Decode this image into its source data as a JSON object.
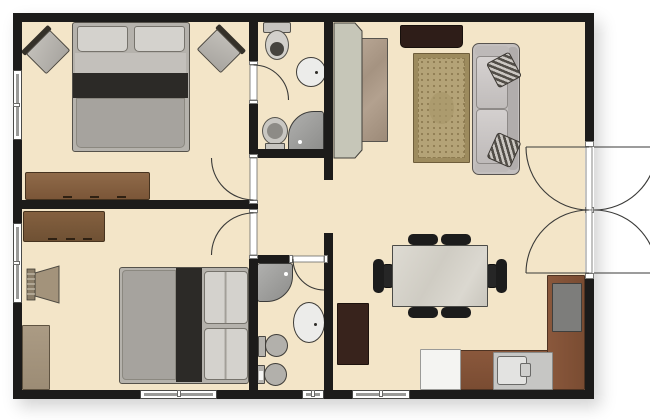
{
  "diagram_type": "apartment-floor-plan",
  "canvas": {
    "w": 650,
    "h": 420
  },
  "palette": {
    "floor": "#f3e5c8",
    "wall": "#1c1b1a",
    "outside": "#ffffff",
    "fixture_light": "#ececea",
    "fixture_gray": "#b2b0ab",
    "shower_gray": "#9b9b99",
    "counter_brown": "#7c4e35",
    "dark_wood": "#2e1d18",
    "mid_wood": "#8a6144",
    "bed_gray": "#a6a39e",
    "bed_dark_band": "#2c2a27",
    "pillow": "#d4d2cd",
    "sofa_gray": "#c3bfbe",
    "rug_tan": "#b4a377",
    "table_stone": "#d9d6ce",
    "chair_black": "#1c1c1c",
    "arc_line": "#3a3a38"
  },
  "rooms": [
    {
      "name": "bedroom-1",
      "bounds": [
        22,
        22,
        227,
        178
      ]
    },
    {
      "name": "ensuite-bathroom",
      "bounds": [
        258,
        22,
        66,
        127
      ]
    },
    {
      "name": "hallway",
      "bounds": [
        258,
        158,
        66,
        97
      ]
    },
    {
      "name": "bedroom-2",
      "bounds": [
        22,
        209,
        227,
        181
      ]
    },
    {
      "name": "bathroom-2",
      "bounds": [
        258,
        263,
        66,
        127
      ]
    },
    {
      "name": "living-dining-kitchen",
      "bounds": [
        333,
        22,
        252,
        368
      ]
    }
  ],
  "walls": [
    {
      "name": "wall-top",
      "r": [
        13,
        13,
        581,
        9
      ]
    },
    {
      "name": "wall-bottom",
      "r": [
        13,
        390,
        581,
        9
      ]
    },
    {
      "name": "wall-left",
      "r": [
        13,
        13,
        9,
        386
      ]
    },
    {
      "name": "wall-right-upper",
      "r": [
        585,
        13,
        9,
        134
      ]
    },
    {
      "name": "wall-right-lower",
      "r": [
        585,
        273,
        9,
        126
      ]
    },
    {
      "name": "wall-bedroom-divider",
      "r": [
        13,
        200,
        245,
        9
      ]
    },
    {
      "name": "wall-v1-a",
      "r": [
        249,
        22,
        9,
        43
      ]
    },
    {
      "name": "wall-v1-b",
      "r": [
        249,
        100,
        9,
        58
      ]
    },
    {
      "name": "wall-v1-c",
      "r": [
        249,
        200,
        9,
        13
      ]
    },
    {
      "name": "wall-v1-d",
      "r": [
        249,
        255,
        9,
        144
      ]
    },
    {
      "name": "wall-v2-a",
      "r": [
        324,
        22,
        9,
        158
      ]
    },
    {
      "name": "wall-v2-b",
      "r": [
        324,
        233,
        9,
        166
      ]
    },
    {
      "name": "wall-bath1-bottom",
      "r": [
        249,
        149,
        84,
        9
      ]
    },
    {
      "name": "wall-bath2-top",
      "r": [
        258,
        255,
        35,
        8
      ]
    }
  ],
  "windows": [
    {
      "name": "window-bedroom1-left",
      "r": [
        13,
        70,
        9,
        70
      ],
      "dir": "v"
    },
    {
      "name": "window-bedroom2-left",
      "r": [
        13,
        223,
        9,
        80
      ],
      "dir": "v"
    },
    {
      "name": "window-bedroom2-bottom",
      "r": [
        140,
        390,
        77,
        9
      ],
      "dir": "h"
    },
    {
      "name": "window-bathroom2-bottom",
      "r": [
        302,
        390,
        22,
        9
      ],
      "dir": "h"
    },
    {
      "name": "window-dining-bottom",
      "r": [
        352,
        390,
        58,
        9
      ],
      "dir": "h"
    }
  ],
  "doors": [
    {
      "name": "door-ensuite",
      "gap": [
        249,
        65,
        9,
        35
      ],
      "leaf": [
        250,
        65,
        7,
        35
      ],
      "jambs": [
        [
          249,
          61,
          9,
          4
        ],
        [
          249,
          100,
          9,
          4
        ]
      ],
      "arcs": [
        "M253.5,65 A35,35 0 0 1 288.5,100"
      ],
      "lines": []
    },
    {
      "name": "door-bedroom1",
      "gap": [
        249,
        158,
        9,
        42
      ],
      "leaf": [
        250,
        158,
        7,
        42
      ],
      "jambs": [
        [
          249,
          154,
          9,
          4
        ],
        [
          249,
          200,
          9,
          4
        ]
      ],
      "arcs": [
        "M211.5,158 A42,42 0 0 0 253.5,200"
      ],
      "lines": []
    },
    {
      "name": "door-bedroom2",
      "gap": [
        249,
        213,
        9,
        42
      ],
      "leaf": [
        250,
        213,
        7,
        42
      ],
      "jambs": [
        [
          249,
          209,
          9,
          4
        ],
        [
          249,
          255,
          9,
          4
        ]
      ],
      "arcs": [
        "M253.5,213 A42,42 0 0 0 211.5,255"
      ],
      "lines": []
    },
    {
      "name": "door-bathroom2",
      "gap": [
        293,
        255,
        31,
        8
      ],
      "leaf": [
        293,
        256,
        31,
        6
      ],
      "jambs": [
        [
          289,
          255,
          4,
          8
        ],
        [
          324,
          255,
          4,
          8
        ]
      ],
      "arcs": [
        "M293,259 A31,31 0 0 0 324,290"
      ],
      "lines": []
    },
    {
      "name": "entry-double-door",
      "gap": [
        585,
        147,
        9,
        126
      ],
      "leaf": [
        586,
        147,
        6,
        63
      ],
      "leaf2": [
        586,
        210,
        6,
        63
      ],
      "jambs": [
        [
          585,
          141,
          9,
          6
        ],
        [
          585,
          273,
          9,
          6
        ],
        [
          585,
          207,
          9,
          6
        ]
      ],
      "arcs": [
        "M526,147 A63,63 0 0 0 589,210",
        "M526,273 A63,63 0 0 1 589,210",
        "M657,147 A63,63 0 0 1 594,210",
        "M657,273 A63,63 0 0 0 594,210"
      ],
      "lines": [
        [
          526,
          147,
          589,
          147
        ],
        [
          526,
          273,
          589,
          273
        ],
        [
          594,
          147,
          657,
          147
        ],
        [
          594,
          273,
          657,
          273
        ]
      ]
    }
  ],
  "furniture": [
    {
      "name": "living-room-rug",
      "type": "rug",
      "r": [
        413,
        53,
        57,
        110
      ]
    },
    {
      "name": "wardrobe-back-panel",
      "type": "svg",
      "items": [
        {
          "k": "polygon",
          "pts": "334,23 355,23 362,31 362,150 355,158 334,158",
          "fill": "#c6c6b8",
          "stroke": "#42403a",
          "sw": 1
        }
      ]
    },
    {
      "name": "wardrobe-stone-front",
      "type": "rect",
      "r": [
        356,
        38,
        32,
        104
      ],
      "grad": "linear-gradient(135deg,#b9a795 0%,#a59381 35%,#b3a18f 60%,#9c8a78 100%)",
      "border": "1px solid #57544e"
    },
    {
      "name": "tv-credenza",
      "type": "rect",
      "r": [
        400,
        25,
        63,
        23
      ],
      "bg": "#2e1d18",
      "border": "1px solid #17100c",
      "radius": "2px 2px 5px 5px"
    },
    {
      "name": "sofa",
      "type": "sofa",
      "r": [
        472,
        43,
        48,
        132
      ]
    },
    {
      "name": "bed-bedroom1",
      "type": "bed",
      "r": [
        72,
        22,
        118,
        130
      ],
      "dir": "down"
    },
    {
      "name": "accent-chair-left",
      "type": "rchair",
      "r": [
        27,
        33,
        40,
        36
      ],
      "rot": -45
    },
    {
      "name": "accent-chair-right",
      "type": "rchair",
      "r": [
        200,
        32,
        40,
        36
      ],
      "rot": 45
    },
    {
      "name": "dresser-bedroom1",
      "type": "dresser",
      "r": [
        25,
        172,
        125,
        28
      ],
      "c1": "#8f6a49",
      "c2": "#7b5638"
    },
    {
      "name": "toilet-ensuite",
      "type": "toilet-v",
      "r": [
        263,
        22,
        28,
        38
      ],
      "tank": "top",
      "inner": "#46443f"
    },
    {
      "name": "sink-ensuite",
      "type": "sink",
      "r": [
        296,
        57,
        30,
        30
      ],
      "dot": [
        18,
        13
      ]
    },
    {
      "name": "bidet-ensuite",
      "type": "toilet-v",
      "r": [
        262,
        117,
        26,
        34
      ],
      "tank": "bottom",
      "inner": "#8d8b86"
    },
    {
      "name": "shower-ensuite",
      "type": "shower",
      "r": [
        288,
        111,
        36,
        41
      ],
      "corner": "tl",
      "dot": [
        9,
        28
      ]
    },
    {
      "name": "bed-bedroom2",
      "type": "bed",
      "r": [
        119,
        267,
        130,
        117
      ],
      "dir": "right"
    },
    {
      "name": "dresser-bedroom2",
      "type": "dresser",
      "r": [
        23,
        211,
        82,
        31
      ],
      "c1": "#84603f",
      "c2": "#6f5134"
    },
    {
      "name": "slat-chair-bedroom2",
      "type": "svg",
      "items": [
        {
          "k": "polygon",
          "pts": "35,273 59,266 59,303 35,296",
          "fill": "#a3937b",
          "stroke": "#4e4a42",
          "sw": 1
        },
        {
          "k": "rect",
          "x": 27,
          "y": 269,
          "w": 8,
          "h": 31,
          "fill": "#8a7d68",
          "stroke": "#403c34",
          "sw": 0.8
        },
        {
          "k": "line",
          "x1": 27,
          "y1": 274,
          "x2": 35,
          "y2": 274,
          "stroke": "#d8d1c1",
          "sw": 1
        },
        {
          "k": "line",
          "x1": 27,
          "y1": 279,
          "x2": 35,
          "y2": 279,
          "stroke": "#d8d1c1",
          "sw": 1
        },
        {
          "k": "line",
          "x1": 27,
          "y1": 284,
          "x2": 35,
          "y2": 284,
          "stroke": "#d8d1c1",
          "sw": 1
        },
        {
          "k": "line",
          "x1": 27,
          "y1": 289,
          "x2": 35,
          "y2": 289,
          "stroke": "#d8d1c1",
          "sw": 1
        },
        {
          "k": "line",
          "x1": 27,
          "y1": 294,
          "x2": 35,
          "y2": 294,
          "stroke": "#d8d1c1",
          "sw": 1
        }
      ]
    },
    {
      "name": "cabinet-bedroom2",
      "type": "rect",
      "r": [
        22,
        325,
        28,
        65
      ],
      "grad": "linear-gradient(180deg,#ab9b84,#9c8c75)",
      "border": "1px solid #5f5341"
    },
    {
      "name": "shower-bathroom2",
      "type": "shower",
      "r": [
        257,
        263,
        36,
        39
      ],
      "corner": "br",
      "dot": [
        26,
        8
      ]
    },
    {
      "name": "sink-bathroom2",
      "type": "sink",
      "r": [
        293,
        302,
        32,
        41
      ],
      "dot": [
        20,
        20
      ]
    },
    {
      "name": "toilet-bathroom2",
      "type": "toilet-s",
      "r": [
        258,
        334,
        30,
        25
      ],
      "tankH": 21,
      "white": false
    },
    {
      "name": "bidet-bathroom2",
      "type": "toilet-s",
      "r": [
        257,
        363,
        30,
        25
      ],
      "tankH": 19,
      "white": true
    },
    {
      "name": "kitchen-counter-bottom",
      "type": "rect",
      "r": [
        457,
        350,
        128,
        40
      ],
      "grad": "linear-gradient(180deg,#8a583c,#7a4c32)",
      "border": "1px solid #4e3322"
    },
    {
      "name": "kitchen-counter-right",
      "type": "rect",
      "r": [
        547,
        275,
        38,
        115
      ],
      "grad": "linear-gradient(90deg,#8a583c,#7a4c32)",
      "border": "1px solid #4e3322"
    },
    {
      "name": "stove",
      "type": "rect",
      "r": [
        552,
        283,
        30,
        49
      ],
      "bg": "#7d7d7b",
      "border": "1.5px solid #3f3f3d"
    },
    {
      "name": "sink-counter-section",
      "type": "rect",
      "r": [
        493,
        352,
        60,
        38
      ],
      "bg": "#c6c6c4",
      "border": "1px solid #8a8a88"
    },
    {
      "name": "kitchen-sink-basin",
      "type": "basin",
      "r": [
        497,
        356,
        30,
        29
      ],
      "faucet": [
        520,
        363,
        11,
        14
      ]
    },
    {
      "name": "fridge",
      "type": "rect",
      "r": [
        420,
        349,
        41,
        41
      ],
      "bg": "#f4f4f2",
      "border": "1.5px solid #9a9a98"
    },
    {
      "name": "dining-chair-top-1",
      "type": "chair",
      "bar": [
        408,
        234,
        30,
        11
      ],
      "seat": [
        412,
        243,
        22,
        12
      ]
    },
    {
      "name": "dining-chair-top-2",
      "type": "chair",
      "bar": [
        441,
        234,
        30,
        11
      ],
      "seat": [
        445,
        243,
        22,
        12
      ]
    },
    {
      "name": "dining-chair-bottom-1",
      "type": "chair",
      "bar": [
        408,
        307,
        30,
        11
      ],
      "seat": [
        412,
        297,
        22,
        12
      ]
    },
    {
      "name": "dining-chair-bottom-2",
      "type": "chair",
      "bar": [
        441,
        307,
        30,
        11
      ],
      "seat": [
        445,
        297,
        22,
        12
      ]
    },
    {
      "name": "dining-chair-left",
      "type": "chair",
      "bar": [
        373,
        259,
        11,
        34
      ],
      "seat": [
        382,
        264,
        12,
        24
      ]
    },
    {
      "name": "dining-chair-right",
      "type": "chair",
      "bar": [
        496,
        259,
        11,
        34
      ],
      "seat": [
        486,
        264,
        12,
        24
      ]
    },
    {
      "name": "dining-table",
      "type": "table",
      "r": [
        392,
        245,
        96,
        62
      ]
    },
    {
      "name": "sideboard-dining",
      "type": "rect",
      "r": [
        337,
        303,
        32,
        62
      ],
      "bg": "#38231c",
      "border": "1px solid #1d120d"
    }
  ]
}
